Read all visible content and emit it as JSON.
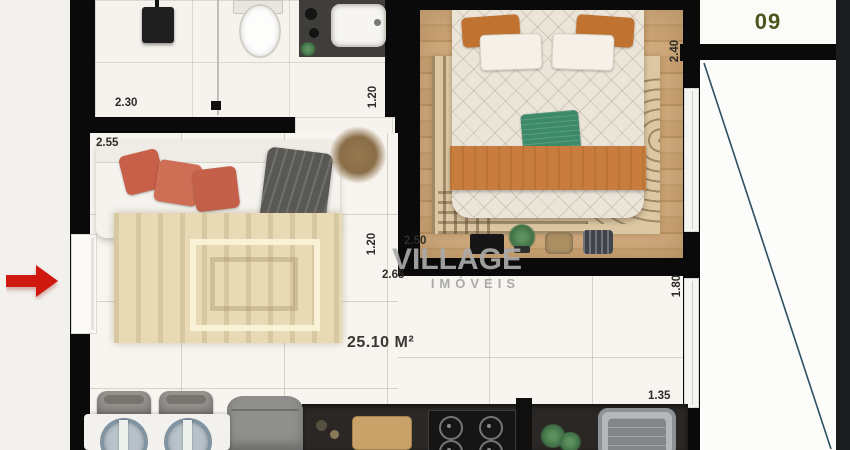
{
  "floor_plan": {
    "unit_number": "09",
    "total_area": "25.10 M²",
    "watermark": {
      "brand": "VILLAGE",
      "sub_brand": "IMÓVEIS"
    },
    "measurements": {
      "bathroom_width": "2.30",
      "bathroom_passage_depth": "1.20",
      "living_width": "2.55",
      "hall_passage_width": "1.20",
      "bedroom_width": "2.50",
      "living_run_length": "2.65",
      "bedroom_depth": "2.40",
      "living_depth": "1.80",
      "kitchen_counter_run": "1.35"
    },
    "colors": {
      "entrance_arrow": "#ce1810",
      "unit_number_text": "#4d541d",
      "section_line": "#2e5062",
      "wall": "#0a0a0a",
      "wood_floor": "#cda677",
      "watermark_gray": "#aaaaaa"
    }
  }
}
